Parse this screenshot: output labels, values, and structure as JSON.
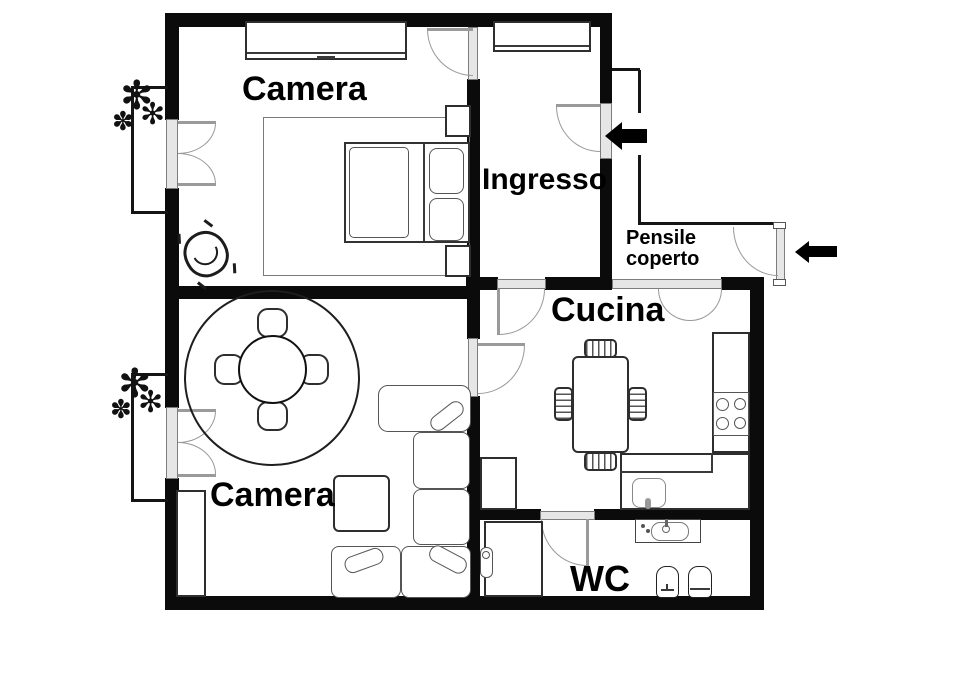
{
  "colors": {
    "wall": "#0b0b0b",
    "furniture_line": "#2e2e2e",
    "door_frame": "#9a9a9a",
    "background": "#ffffff"
  },
  "rooms": {
    "camera_top": {
      "label": "Camera"
    },
    "ingresso": {
      "label": "Ingresso"
    },
    "pensile_coperto": {
      "lines": [
        "Pensile",
        "coperto"
      ]
    },
    "cucina": {
      "label": "Cucina"
    },
    "camera_bottom": {
      "label": "Camera"
    },
    "wc": {
      "label": "WC"
    }
  }
}
